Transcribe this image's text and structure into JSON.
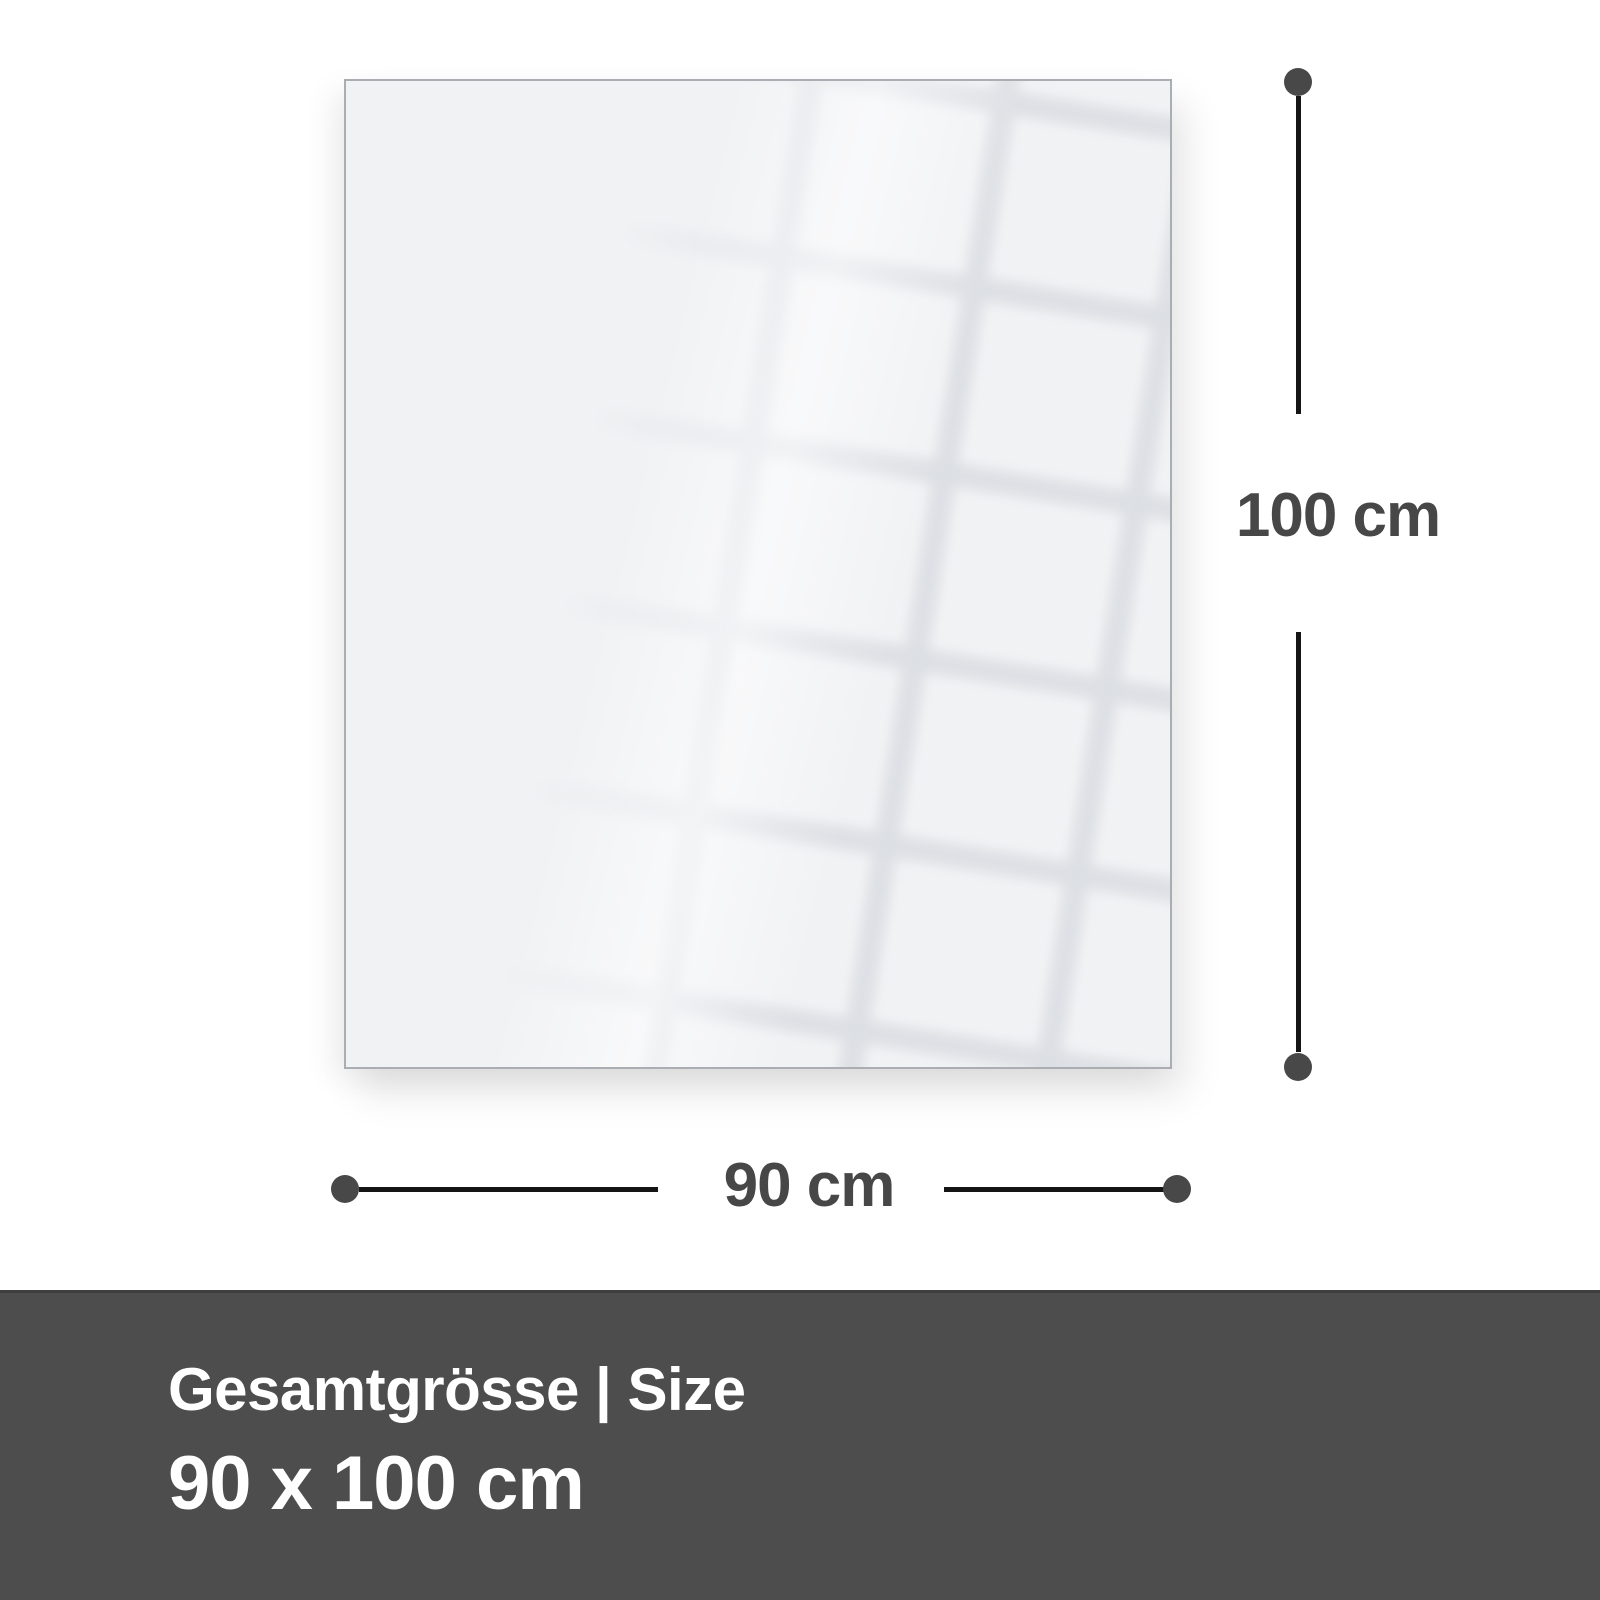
{
  "diagram": {
    "dimensions": {
      "height": {
        "label": "100 cm"
      },
      "width": {
        "label": "90 cm"
      }
    }
  },
  "footer": {
    "title": "Gesamtgrösse | Size",
    "size": "90 x 100 cm"
  },
  "colors": {
    "page_background": "#ffffff",
    "panel_fill": "#f1f2f4",
    "panel_border": "#aaaeb3",
    "dimension_line": "#151515",
    "dimension_dot": "#484848",
    "dimension_label": "#474747",
    "footer_background": "#4d4d4d",
    "footer_text": "#ffffff"
  }
}
